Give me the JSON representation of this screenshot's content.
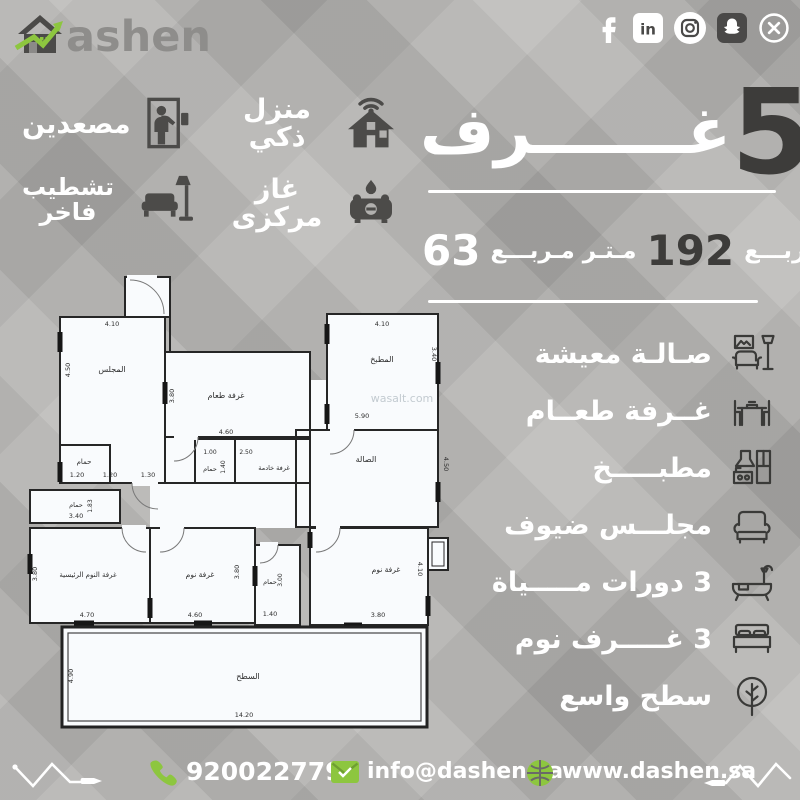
{
  "brand": {
    "logo_full": "Dashen",
    "logo_rest": "ashen"
  },
  "social": {
    "icons": [
      "facebook",
      "linkedin",
      "instagram",
      "snapchat",
      "x"
    ]
  },
  "features": [
    {
      "label": "مصعدين",
      "icon": "elevator-icon"
    },
    {
      "label": "منزل ذكي",
      "icon": "smart-home-icon"
    },
    {
      "line1": "تشطيب",
      "line2": "فاخر",
      "icon": "furnishing-icon"
    },
    {
      "label": "غاز مركزى",
      "icon": "gas-stove-icon"
    }
  ],
  "headline": {
    "count": "5",
    "word": "غـــــــرف"
  },
  "area": {
    "value_small": "63",
    "unit_small": "مـتـر مـربـــع",
    "value_large": "192",
    "unit_large": "مـتـر مـربـــع"
  },
  "amenities": [
    {
      "label": "صـالـة معيشة",
      "icon": "living-room-icon"
    },
    {
      "label": "غــرفة طعــام",
      "icon": "dining-room-icon"
    },
    {
      "label": "مطبـــــخ",
      "icon": "kitchen-icon"
    },
    {
      "label": "مجلـــس ضيوف",
      "icon": "guest-majlis-icon"
    },
    {
      "label": "3 دورات مـــــياة",
      "icon": "bathroom-icon"
    },
    {
      "label": "3 غـــــرف نوم",
      "icon": "bedroom-icon"
    },
    {
      "label": "سطح واسع",
      "icon": "roof-tree-icon"
    }
  ],
  "plan": {
    "watermark": "wasalt.com",
    "majlis": {
      "name": "المجلس",
      "d_top": "4.10",
      "d_left": "4.50"
    },
    "dining": {
      "name": "غرفة طعام",
      "d_bottom": "4.60",
      "d_left": "3.80"
    },
    "kitchen": {
      "name": "المطبخ",
      "d_top": "4.10",
      "d_right": "3.40"
    },
    "hall": {
      "name": "الصالة",
      "d_mid": "5.90",
      "d_right": "4.50"
    },
    "bath_top": {
      "name": "حمام",
      "d": "1.20"
    },
    "corridor": {
      "d1": "1.20",
      "d2": "1.30"
    },
    "bath_small": {
      "name": "حمام",
      "d_top1": "1.00",
      "d_top2": "2.50",
      "d_mid": "1.40"
    },
    "maid": {
      "name": "غرفة خادمة"
    },
    "bath_left": {
      "name": "حمام",
      "d_v": "1.83",
      "d_h": "3.40"
    },
    "master": {
      "name": "غرفة النوم الرئيسية",
      "d_bottom": "4.70",
      "d_left": "3.80"
    },
    "bed2": {
      "name": "غرفة نوم",
      "d_bottom": "4.60",
      "d_right": "3.80"
    },
    "bath_mid": {
      "name": "حمام",
      "d_v": "3.00",
      "d_bottom": "1.40"
    },
    "bed3": {
      "name": "غرفة نوم",
      "d_bottom": "3.80",
      "d_right": "4.10"
    },
    "roof": {
      "name": "السطح",
      "d_bottom": "14.20",
      "d_left": "4.90"
    }
  },
  "footer": {
    "phone": "920022779",
    "email": "info@dashen.sa",
    "website": "www.dashen.sa"
  },
  "colors": {
    "accent_green": "#8dc63f",
    "dark_gray": "#3d3c3a",
    "background_gray": "#b2b1af",
    "plan_fill": "#f9fbfd"
  }
}
